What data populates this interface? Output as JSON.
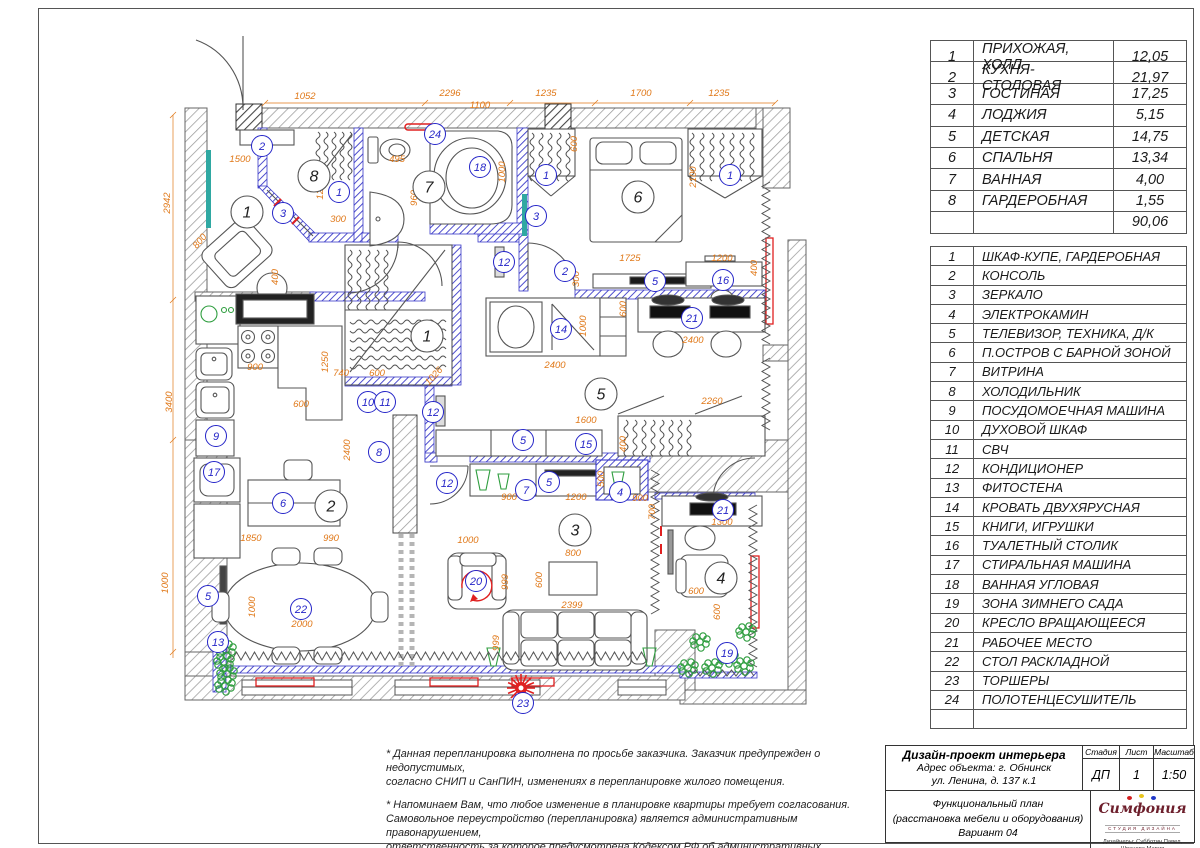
{
  "colors": {
    "dim": "#e07818",
    "item": "#2525c8",
    "wallnew": "#3a3ac8",
    "red": "#e02020",
    "green": "#2f9e3f",
    "teal": "#2fa8a2"
  },
  "room_table": {
    "rows": [
      {
        "n": "1",
        "name": "ПРИХОЖАЯ, ХОЛЛ",
        "area": "12,05"
      },
      {
        "n": "2",
        "name": "КУХНЯ-СТОЛОВАЯ",
        "area": "21,97"
      },
      {
        "n": "3",
        "name": "ГОСТИНАЯ",
        "area": "17,25"
      },
      {
        "n": "4",
        "name": "ЛОДЖИЯ",
        "area": "5,15"
      },
      {
        "n": "5",
        "name": "ДЕТСКАЯ",
        "area": "14,75"
      },
      {
        "n": "6",
        "name": "СПАЛЬНЯ",
        "area": "13,34"
      },
      {
        "n": "7",
        "name": "ВАННАЯ",
        "area": "4,00"
      },
      {
        "n": "8",
        "name": "ГАРДЕРОБНАЯ",
        "area": "1,55"
      }
    ],
    "total": "90,06"
  },
  "legend_table": {
    "rows": [
      {
        "n": "1",
        "name": "ШКАФ-КУПЕ, ГАРДЕРОБНАЯ"
      },
      {
        "n": "2",
        "name": "КОНСОЛЬ"
      },
      {
        "n": "3",
        "name": "ЗЕРКАЛО"
      },
      {
        "n": "4",
        "name": "ЭЛЕКТРОКАМИН"
      },
      {
        "n": "5",
        "name": "ТЕЛЕВИЗОР, ТЕХНИКА, Д/К"
      },
      {
        "n": "6",
        "name": "П.ОСТРОВ С БАРНОЙ ЗОНОЙ"
      },
      {
        "n": "7",
        "name": "ВИТРИНА"
      },
      {
        "n": "8",
        "name": "ХОЛОДИЛЬНИК"
      },
      {
        "n": "9",
        "name": "ПОСУДОМОЕЧНАЯ МАШИНА"
      },
      {
        "n": "10",
        "name": "ДУХОВОЙ ШКАФ"
      },
      {
        "n": "11",
        "name": "СВЧ"
      },
      {
        "n": "12",
        "name": "КОНДИЦИОНЕР"
      },
      {
        "n": "13",
        "name": "ФИТОСТЕНА"
      },
      {
        "n": "14",
        "name": "КРОВАТЬ ДВУХЯРУСНАЯ"
      },
      {
        "n": "15",
        "name": "КНИГИ, ИГРУШКИ"
      },
      {
        "n": "16",
        "name": "ТУАЛЕТНЫЙ СТОЛИК"
      },
      {
        "n": "17",
        "name": "СТИРАЛЬНАЯ МАШИНА"
      },
      {
        "n": "18",
        "name": "ВАННАЯ УГЛОВАЯ"
      },
      {
        "n": "19",
        "name": "ЗОНА ЗИМНЕГО САДА"
      },
      {
        "n": "20",
        "name": "КРЕСЛО ВРАЩАЮЩЕЕСЯ"
      },
      {
        "n": "21",
        "name": "РАБОЧЕЕ МЕСТО"
      },
      {
        "n": "22",
        "name": "СТОЛ РАСКЛАДНОЙ"
      },
      {
        "n": "23",
        "name": "ТОРШЕРЫ"
      },
      {
        "n": "24",
        "name": "ПОЛОТЕНЦЕСУШИТЕЛЬ"
      }
    ]
  },
  "notes": {
    "p1": [
      "* Данная перепланировка выполнена по просьбе заказчика. Заказчик предупрежден о недопустимых,",
      "согласно СНИП и СанПИН, изменениях в перепланировке жилого помещения."
    ],
    "p2": [
      "* Напоминаем Вам, что любое изменение в планировке квартиры требует согласования.",
      "Самовольное переустройство (перепланировка) является административным правонарушением,",
      "ответственность за которое предусмотрена Кодексом РФ об административных правонарушениях,",
      "Жилищным кодексом РФ, Кодексом города об административных правонарушениях."
    ]
  },
  "title_block": {
    "project": "Дизайн-проект интерьера",
    "address1": "Адрес объекта: г. Обнинск",
    "address2": "ул. Ленина, д. 137 к.1",
    "stage_label": "Стадия",
    "sheet_label": "Лист",
    "scale_label": "Масштаб",
    "stage": "ДП",
    "sheet": "1",
    "scale": "1:50",
    "drawing1": "Функциональный план",
    "drawing2": "(расстановка мебели и оборудования)",
    "drawing3": "Вариант 04",
    "logo_name": "Симфония",
    "logo_sub": "СТУДИЯ ДИЗАЙНА",
    "designers": "Дизайнеры: Субботин Павел, Шванова Мария",
    "phone": "8-910-912-1369"
  },
  "plan": {
    "room_markers": [
      {
        "n": "1",
        "x": 247,
        "y": 212
      },
      {
        "n": "1",
        "x": 427,
        "y": 336
      },
      {
        "n": "8",
        "x": 314,
        "y": 176
      },
      {
        "n": "7",
        "x": 429,
        "y": 187
      },
      {
        "n": "6",
        "x": 638,
        "y": 197
      },
      {
        "n": "2",
        "x": 331,
        "y": 506
      },
      {
        "n": "5",
        "x": 601,
        "y": 394
      },
      {
        "n": "3",
        "x": 575,
        "y": 530
      },
      {
        "n": "4",
        "x": 721,
        "y": 578
      }
    ],
    "item_markers": [
      {
        "n": "2",
        "x": 262,
        "y": 146
      },
      {
        "n": "3",
        "x": 283,
        "y": 213
      },
      {
        "n": "1",
        "x": 339,
        "y": 192
      },
      {
        "n": "24",
        "x": 435,
        "y": 134
      },
      {
        "n": "18",
        "x": 480,
        "y": 167
      },
      {
        "n": "1",
        "x": 546,
        "y": 175
      },
      {
        "n": "1",
        "x": 730,
        "y": 175
      },
      {
        "n": "3",
        "x": 536,
        "y": 216
      },
      {
        "n": "12",
        "x": 504,
        "y": 262
      },
      {
        "n": "2",
        "x": 565,
        "y": 271
      },
      {
        "n": "5",
        "x": 655,
        "y": 281
      },
      {
        "n": "16",
        "x": 723,
        "y": 280
      },
      {
        "n": "21",
        "x": 692,
        "y": 318
      },
      {
        "n": "14",
        "x": 561,
        "y": 329
      },
      {
        "n": "10",
        "x": 368,
        "y": 402
      },
      {
        "n": "11",
        "x": 385,
        "y": 402
      },
      {
        "n": "8",
        "x": 379,
        "y": 452
      },
      {
        "n": "12",
        "x": 433,
        "y": 412
      },
      {
        "n": "12",
        "x": 447,
        "y": 483
      },
      {
        "n": "9",
        "x": 216,
        "y": 436
      },
      {
        "n": "17",
        "x": 214,
        "y": 472
      },
      {
        "n": "6",
        "x": 283,
        "y": 503
      },
      {
        "n": "5",
        "x": 523,
        "y": 440
      },
      {
        "n": "15",
        "x": 586,
        "y": 444
      },
      {
        "n": "7",
        "x": 526,
        "y": 490
      },
      {
        "n": "5",
        "x": 549,
        "y": 482
      },
      {
        "n": "4",
        "x": 620,
        "y": 492
      },
      {
        "n": "21",
        "x": 723,
        "y": 510
      },
      {
        "n": "22",
        "x": 301,
        "y": 609
      },
      {
        "n": "13",
        "x": 218,
        "y": 642
      },
      {
        "n": "5",
        "x": 208,
        "y": 596
      },
      {
        "n": "20",
        "x": 476,
        "y": 581
      },
      {
        "n": "23",
        "x": 523,
        "y": 703
      },
      {
        "n": "19",
        "x": 727,
        "y": 653
      }
    ],
    "dims": [
      {
        "t": "1052",
        "x": 305,
        "y": 99
      },
      {
        "t": "2296",
        "x": 450,
        "y": 96
      },
      {
        "t": "1100",
        "x": 480,
        "y": 108
      },
      {
        "t": "1235",
        "x": 546,
        "y": 96
      },
      {
        "t": "1700",
        "x": 641,
        "y": 96
      },
      {
        "t": "1235",
        "x": 719,
        "y": 96
      },
      {
        "t": "2942",
        "x": 170,
        "y": 203,
        "r": -90
      },
      {
        "t": "3400",
        "x": 172,
        "y": 402,
        "r": -90
      },
      {
        "t": "1000",
        "x": 168,
        "y": 583,
        "r": -90
      },
      {
        "t": "1500",
        "x": 240,
        "y": 162
      },
      {
        "t": "800",
        "x": 202,
        "y": 243,
        "r": -50
      },
      {
        "t": "799",
        "x": 247,
        "y": 206,
        "r": -50
      },
      {
        "t": "400",
        "x": 278,
        "y": 277,
        "r": -90
      },
      {
        "t": "1200",
        "x": 323,
        "y": 189,
        "r": -90
      },
      {
        "t": "300",
        "x": 338,
        "y": 222
      },
      {
        "t": "495",
        "x": 397,
        "y": 162
      },
      {
        "t": "960",
        "x": 417,
        "y": 198,
        "r": -90
      },
      {
        "t": "1000",
        "x": 505,
        "y": 172,
        "r": -90
      },
      {
        "t": "600",
        "x": 577,
        "y": 144,
        "r": -90
      },
      {
        "t": "2100",
        "x": 696,
        "y": 177,
        "r": -90
      },
      {
        "t": "1725",
        "x": 630,
        "y": 261
      },
      {
        "t": "1200",
        "x": 722,
        "y": 261
      },
      {
        "t": "300",
        "x": 579,
        "y": 279,
        "r": -90
      },
      {
        "t": "400",
        "x": 757,
        "y": 268,
        "r": -90
      },
      {
        "t": "900",
        "x": 255,
        "y": 370
      },
      {
        "t": "1250",
        "x": 328,
        "y": 362,
        "r": -90
      },
      {
        "t": "740",
        "x": 341,
        "y": 376
      },
      {
        "t": "600",
        "x": 377,
        "y": 376
      },
      {
        "t": "600",
        "x": 301,
        "y": 407
      },
      {
        "t": "2400",
        "x": 350,
        "y": 450,
        "r": -90
      },
      {
        "t": "1026",
        "x": 436,
        "y": 378,
        "r": -48
      },
      {
        "t": "1000",
        "x": 586,
        "y": 326,
        "r": -90
      },
      {
        "t": "2400",
        "x": 555,
        "y": 368
      },
      {
        "t": "600",
        "x": 626,
        "y": 309,
        "r": -90
      },
      {
        "t": "2400",
        "x": 693,
        "y": 343
      },
      {
        "t": "2260",
        "x": 712,
        "y": 404
      },
      {
        "t": "1600",
        "x": 586,
        "y": 423
      },
      {
        "t": "400",
        "x": 626,
        "y": 444,
        "r": -90
      },
      {
        "t": "900",
        "x": 509,
        "y": 500
      },
      {
        "t": "1200",
        "x": 576,
        "y": 500
      },
      {
        "t": "500",
        "x": 604,
        "y": 479,
        "r": -90
      },
      {
        "t": "900",
        "x": 640,
        "y": 501
      },
      {
        "t": "1850",
        "x": 251,
        "y": 541
      },
      {
        "t": "990",
        "x": 331,
        "y": 541
      },
      {
        "t": "1000",
        "x": 255,
        "y": 607,
        "r": -90
      },
      {
        "t": "2000",
        "x": 302,
        "y": 627
      },
      {
        "t": "1000",
        "x": 468,
        "y": 543
      },
      {
        "t": "999",
        "x": 508,
        "y": 582,
        "r": -90
      },
      {
        "t": "800",
        "x": 573,
        "y": 556
      },
      {
        "t": "600",
        "x": 542,
        "y": 580,
        "r": -90
      },
      {
        "t": "2399",
        "x": 572,
        "y": 608
      },
      {
        "t": "999",
        "x": 499,
        "y": 643,
        "r": -90
      },
      {
        "t": "700",
        "x": 655,
        "y": 512,
        "r": -90
      },
      {
        "t": "1300",
        "x": 722,
        "y": 525
      },
      {
        "t": "600",
        "x": 696,
        "y": 594
      },
      {
        "t": "600",
        "x": 720,
        "y": 612,
        "r": -90
      }
    ]
  }
}
